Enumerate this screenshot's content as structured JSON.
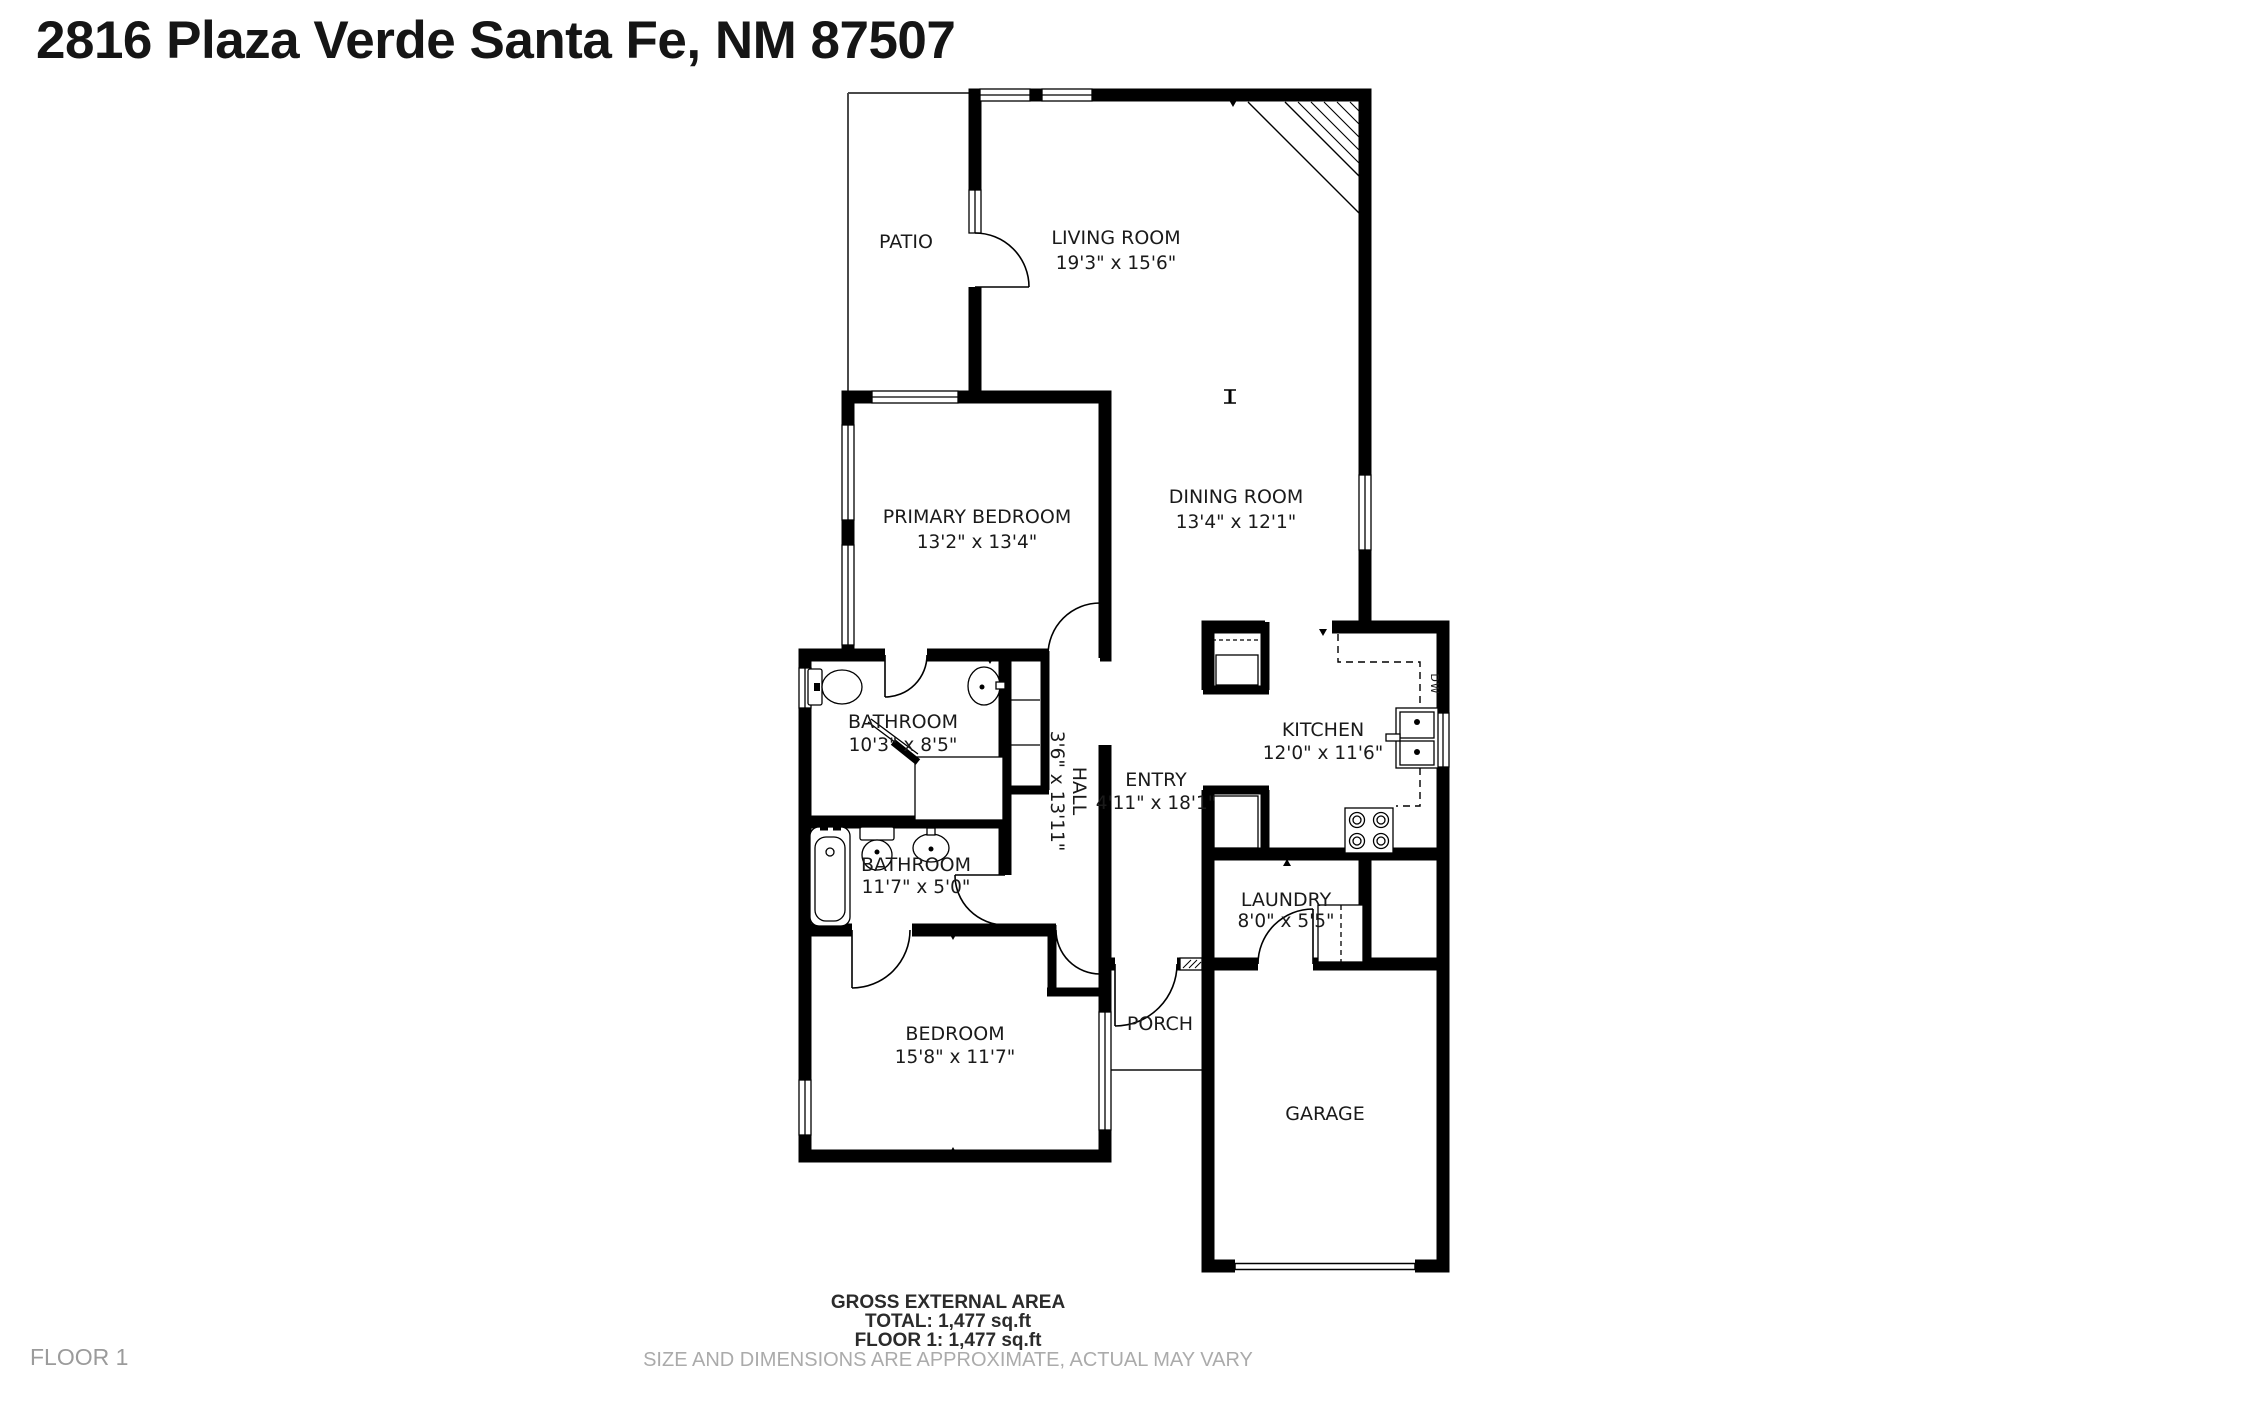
{
  "title": "2816 Plaza Verde Santa Fe, NM 87507",
  "floor_label": "FLOOR 1",
  "rooms": {
    "patio": {
      "name": "PATIO",
      "dims": ""
    },
    "living": {
      "name": "LIVING ROOM",
      "dims": "19'3\" x 15'6\""
    },
    "dining": {
      "name": "DINING ROOM",
      "dims": "13'4\" x 12'1\""
    },
    "primary": {
      "name": "PRIMARY BEDROOM",
      "dims": "13'2\" x 13'4\""
    },
    "bathroom1": {
      "name": "BATHROOM",
      "dims": "10'3\" x 8'5\""
    },
    "hall": {
      "name": "HALL",
      "dims": "3'6\" x 13'11\""
    },
    "entry": {
      "name": "ENTRY",
      "dims": "4'11\" x 18'1\""
    },
    "kitchen": {
      "name": "KITCHEN",
      "dims": "12'0\" x 11'6\""
    },
    "bathroom2": {
      "name": "BATHROOM",
      "dims": "11'7\" x 5'0\""
    },
    "laundry": {
      "name": "LAUNDRY",
      "dims": "8'0\" x 5'5\""
    },
    "bedroom": {
      "name": "BEDROOM",
      "dims": "15'8\" x 11'7\""
    },
    "porch": {
      "name": "PORCH",
      "dims": ""
    },
    "garage": {
      "name": "GARAGE",
      "dims": ""
    }
  },
  "fixtures": {
    "dishwasher_label": "DW"
  },
  "footer": {
    "area_title": "GROSS EXTERNAL AREA",
    "total": "TOTAL: 1,477 sq.ft",
    "floor1": "FLOOR 1: 1,477 sq.ft",
    "disclaimer": "SIZE AND DIMENSIONS ARE APPROXIMATE, ACTUAL MAY VARY"
  },
  "colors": {
    "wall": "#000000",
    "text": "#1a1a1a",
    "muted": "#ababab"
  }
}
